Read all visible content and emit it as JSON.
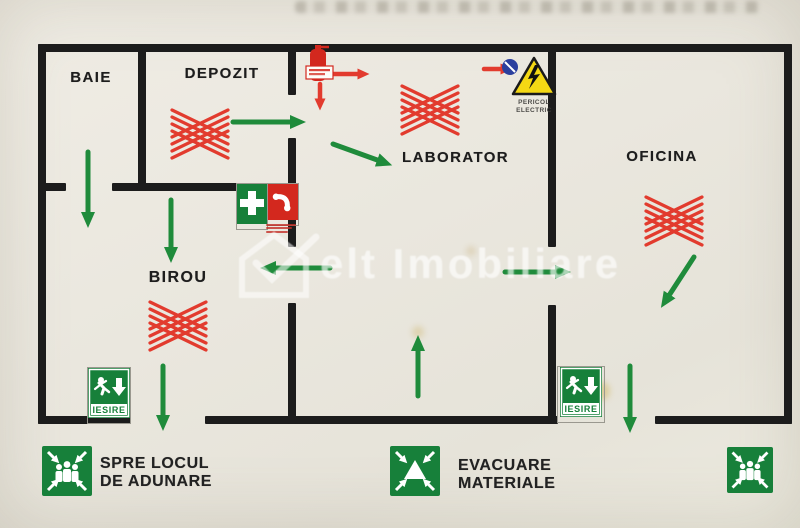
{
  "rooms": [
    {
      "label": "BAIE"
    },
    {
      "label": "DEPOZIT"
    },
    {
      "label": "LABORATOR"
    },
    {
      "label": "OFICINA"
    },
    {
      "label": "BIROU"
    }
  ],
  "signs": {
    "exit_left": {
      "label": "IESIRE"
    },
    "exit_right": {
      "label": "IESIRE"
    },
    "electric": {
      "line1": "PERICOL",
      "line2": "ELECTRIC"
    }
  },
  "legend": {
    "assembly": {
      "line1": "SPRE LOCUL",
      "line2": "DE ADUNARE"
    },
    "materials": {
      "line1": "EVACUARE",
      "line2": "MATERIALE"
    }
  },
  "watermark": {
    "text": "elt Imobiliare"
  },
  "icons": {
    "extinguisher": "fire-extinguisher-icon",
    "first_aid": "first-aid-cross-icon",
    "phone": "emergency-phone-icon",
    "electric_warning": "electric-hazard-triangle-icon",
    "exit": "running-man-exit-icon",
    "assembly": "assembly-point-icon",
    "materials": "evacuate-materials-icon",
    "blocked": "red-crosshatch-blocked-icon",
    "route": "green-route-arrow-icon"
  },
  "colors": {
    "route_green": "#1f8b3b",
    "hazard_red": "#e23b2e",
    "sign_green": "#17803a",
    "warning_yellow": "#f4d814",
    "wall_black": "#1c1c1c",
    "paper": "#eae7de"
  }
}
